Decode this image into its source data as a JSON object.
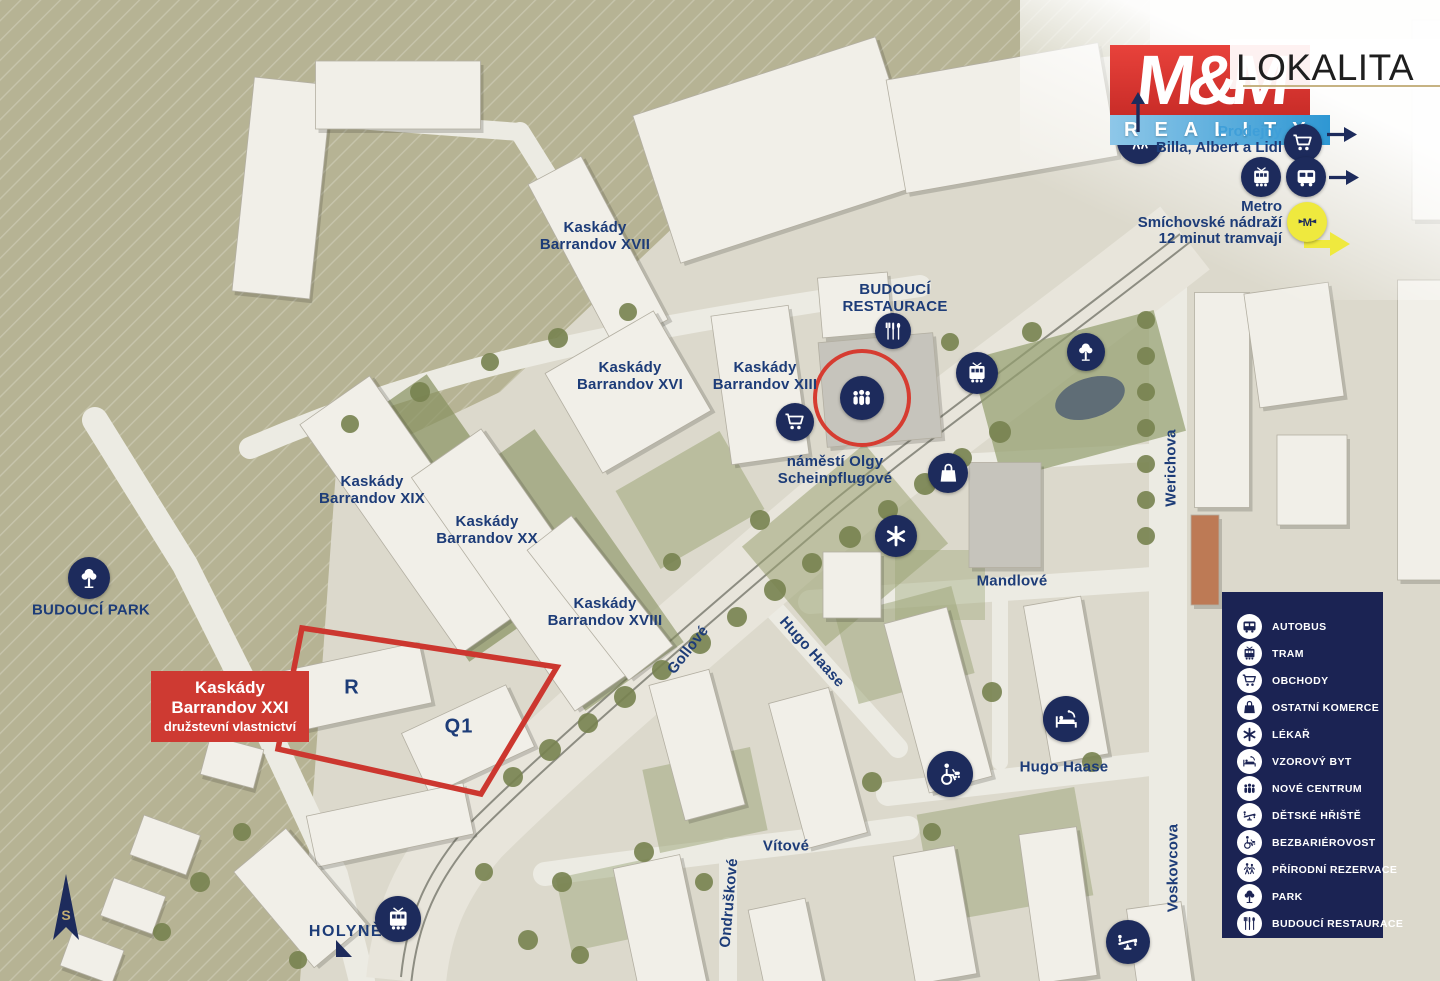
{
  "branding": {
    "mm": "M&M",
    "reality": "REALITY",
    "lokalita": "LOKALITA"
  },
  "transit": {
    "shops_line1": "Prodejny",
    "shops_line2": "Billa, Albert a Lidl",
    "metro_line1": "Metro",
    "metro_line2": "Smíchovské nádraží",
    "metro_line3": "12 minut tramvají"
  },
  "header_icons": [
    {
      "icon": "walkers",
      "name": "header-nature-icon",
      "x": 1140,
      "y": 141,
      "d": 46,
      "z": 5
    },
    {
      "icon": "cart",
      "name": "header-shops-icon",
      "x": 1303,
      "y": 143,
      "d": 38,
      "z": 7
    },
    {
      "icon": "tram",
      "name": "header-tram-icon",
      "x": 1261,
      "y": 177,
      "d": 40,
      "z": 7
    },
    {
      "icon": "bus",
      "name": "header-bus-icon",
      "x": 1306,
      "y": 177,
      "d": 40,
      "z": 7
    },
    {
      "icon": "metro",
      "name": "header-metro-icon",
      "x": 1307,
      "y": 222,
      "d": 40,
      "z": 7,
      "bg": "#efe93e",
      "fg": "#1d2b5c"
    }
  ],
  "highlight": {
    "title": "Kaskády\nBarrandov XXI",
    "subtitle": "družstevní vlastnictví"
  },
  "map": {
    "labels": [
      {
        "text": "Kaskády\nBarrandov XVII",
        "x": 595,
        "y": 236,
        "cls": "area",
        "name": "label-kaskady-barrandov-xvii"
      },
      {
        "text": "Kaskády\nBarrandov XVI",
        "x": 630,
        "y": 376,
        "cls": "area",
        "name": "label-kaskady-barrandov-xvi"
      },
      {
        "text": "Kaskády\nBarrandov XIII",
        "x": 765,
        "y": 376,
        "cls": "area",
        "name": "label-kaskady-barrandov-xiii"
      },
      {
        "text": "BUDOUCÍ\nRESTAURACE",
        "x": 895,
        "y": 298,
        "cls": "area",
        "name": "label-budouci-restaurace"
      },
      {
        "text": "náměstí Olgy\nScheinpflugové",
        "x": 835,
        "y": 470,
        "cls": "area",
        "name": "label-namesti-olgy-scheinpflugove"
      },
      {
        "text": "Kaskády\nBarrandov XIX",
        "x": 372,
        "y": 490,
        "cls": "area",
        "name": "label-kaskady-barrandov-xix"
      },
      {
        "text": "Kaskády\nBarrandov XX",
        "x": 487,
        "y": 530,
        "cls": "area",
        "name": "label-kaskady-barrandov-xx"
      },
      {
        "text": "Kaskády\nBarrandov XVIII",
        "x": 605,
        "y": 612,
        "cls": "area",
        "name": "label-kaskady-barrandov-xviii"
      },
      {
        "text": "BUDOUCÍ PARK",
        "x": 91,
        "y": 610,
        "cls": "area",
        "name": "label-budouci-park"
      },
      {
        "text": "Mandlové",
        "x": 1012,
        "y": 581,
        "cls": "street",
        "name": "street-mandlove"
      },
      {
        "text": "Hugo Haase",
        "x": 1064,
        "y": 767,
        "cls": "street",
        "name": "street-hugo-haase"
      },
      {
        "text": "Vítové",
        "x": 786,
        "y": 846,
        "cls": "street",
        "name": "street-vitove"
      },
      {
        "text": "HOLYNĚ",
        "x": 346,
        "y": 932,
        "cls": "holyne",
        "name": "label-holyne"
      },
      {
        "text": "Ondruškové",
        "x": 729,
        "y": 903,
        "rot": -85,
        "cls": "street",
        "name": "street-ondruskove"
      },
      {
        "text": "Gollové",
        "x": 688,
        "y": 650,
        "rot": -52,
        "cls": "street",
        "name": "street-gollove"
      },
      {
        "text": "Hugo Haase",
        "x": 812,
        "y": 652,
        "rot": 48,
        "cls": "street",
        "name": "street-hugo-haase-diagonal"
      },
      {
        "text": "Werichova",
        "x": 1171,
        "y": 468,
        "rot": -90,
        "cls": "street",
        "name": "street-werichova"
      },
      {
        "text": "Voskovcova",
        "x": 1173,
        "y": 868,
        "rot": -90,
        "cls": "street",
        "name": "street-voskovcova"
      },
      {
        "text": "R",
        "x": 352,
        "y": 688,
        "cls": "bletter",
        "name": "building-letter-r"
      },
      {
        "text": "Q1",
        "x": 459,
        "y": 727,
        "cls": "bletter",
        "name": "building-letter-q1"
      }
    ],
    "icons": [
      {
        "icon": "utensils",
        "name": "poi-restaurant",
        "x": 893,
        "y": 331,
        "d": 36
      },
      {
        "icon": "people",
        "name": "poi-nove-centrum",
        "x": 862,
        "y": 398,
        "d": 44
      },
      {
        "icon": "cart",
        "name": "poi-shop",
        "x": 795,
        "y": 422,
        "d": 38
      },
      {
        "icon": "tram",
        "name": "poi-tram-stop",
        "x": 977,
        "y": 373,
        "d": 42
      },
      {
        "icon": "tree",
        "name": "poi-park",
        "x": 1086,
        "y": 352,
        "d": 38
      },
      {
        "icon": "bag",
        "name": "poi-commerce",
        "x": 948,
        "y": 473,
        "d": 40
      },
      {
        "icon": "medical",
        "name": "poi-doctor",
        "x": 896,
        "y": 536,
        "d": 42
      },
      {
        "icon": "bed",
        "name": "poi-show-flat",
        "x": 1066,
        "y": 719,
        "d": 46
      },
      {
        "icon": "wheelchair",
        "name": "poi-accessibility",
        "x": 950,
        "y": 774,
        "d": 46
      },
      {
        "icon": "seesaw",
        "name": "poi-playground",
        "x": 1128,
        "y": 942,
        "d": 44
      },
      {
        "icon": "tram",
        "name": "poi-tram-stop-holyne",
        "x": 398,
        "y": 919,
        "d": 46
      },
      {
        "icon": "tree",
        "name": "poi-future-park",
        "x": 89,
        "y": 578,
        "d": 42
      }
    ]
  },
  "legend": {
    "items": [
      {
        "icon": "bus",
        "label": "AUTOBUS"
      },
      {
        "icon": "tram",
        "label": "TRAM"
      },
      {
        "icon": "cart",
        "label": "OBCHODY"
      },
      {
        "icon": "bag",
        "label": "OSTATNÍ KOMERCE"
      },
      {
        "icon": "medical",
        "label": "LÉKAŘ"
      },
      {
        "icon": "bed",
        "label": "VZOROVÝ BYT"
      },
      {
        "icon": "people",
        "label": "NOVÉ CENTRUM"
      },
      {
        "icon": "seesaw",
        "label": "DĚTSKÉ HŘIŠTĚ"
      },
      {
        "icon": "wheelchair",
        "label": "BEZBARIÉROVOST"
      },
      {
        "icon": "walkers",
        "label": "PŘÍRODNÍ REZERVACE"
      },
      {
        "icon": "tree",
        "label": "PARK"
      },
      {
        "icon": "utensils",
        "label": "BUDOUCÍ RESTAURACE"
      }
    ]
  },
  "compass": {
    "label": "S"
  },
  "colors": {
    "navy": "#1d2b5c",
    "legend_bg": "#1b2353",
    "label_navy": "#1d3c78",
    "red": "#ce3a32",
    "outline_red": "#cc372f",
    "blue": "#2e97d3",
    "yellow": "#efe93e",
    "gold": "#c6b383",
    "olive": "#b6b394",
    "beige": "#dcd9cc"
  }
}
